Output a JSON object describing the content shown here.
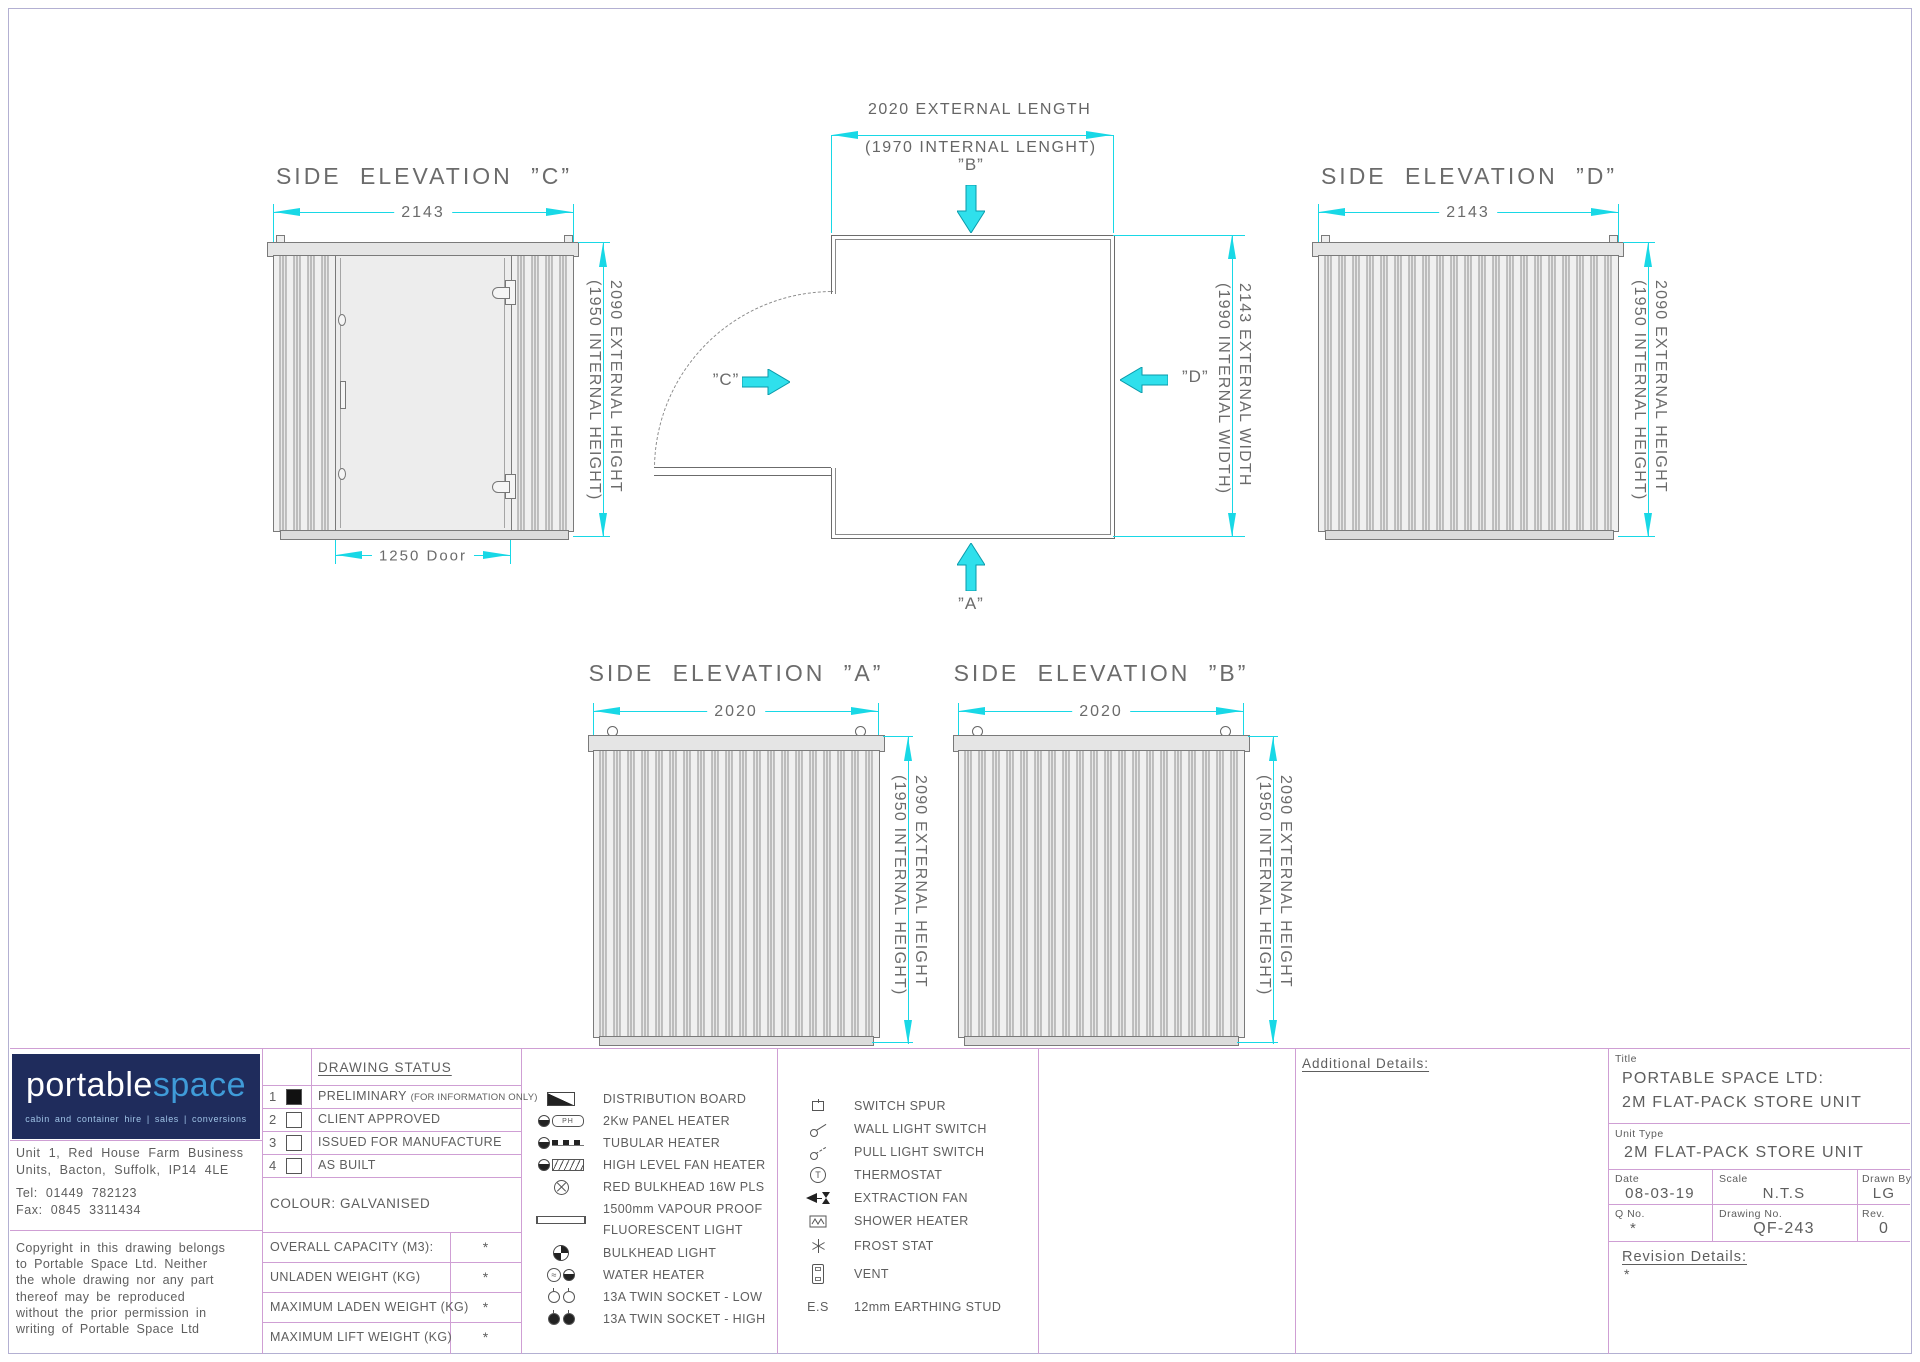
{
  "drawing": {
    "elev_c": {
      "title": "SIDE ELEVATION ”C”",
      "width_dim": "2143",
      "door_dim": "1250 Door"
    },
    "elev_d": {
      "title": "SIDE ELEVATION ”D”",
      "width_dim": "2143"
    },
    "elev_a": {
      "title": "SIDE ELEVATION ”A”",
      "width_dim": "2020"
    },
    "elev_b": {
      "title": "SIDE ELEVATION ”B”",
      "width_dim": "2020"
    },
    "height_dim": {
      "line1": "2090 EXTERNAL HEIGHT",
      "line2": "(1950 INTERNAL HEIGHT)"
    },
    "plan": {
      "length_dim_line1": "2020 EXTERNAL LENGTH",
      "length_dim_line2": "(1970 INTERNAL LENGHT)",
      "width_dim_line1": "2143 EXTERNAL WIDTH",
      "width_dim_line2": "(1990 INTERNAL WIDTH)",
      "label_a": "”A”",
      "label_b": "”B”",
      "label_c": "”C”",
      "label_d": "”D”"
    }
  },
  "title_block": {
    "logo": {
      "brand1": "portable",
      "brand2": "space",
      "tagline": "cabin and container hire   |   sales   |   conversions"
    },
    "address": {
      "line1": "Unit 1, Red House Farm Business",
      "line2": "Units, Bacton, Suffolk, IP14 4LE",
      "tel": "Tel:  01449 782123",
      "fax": "Fax:  0845 3311434"
    },
    "copyright": "Copyright in this drawing belongs\nto Portable Space Ltd. Neither\nthe whole drawing nor any part\nthereof may be reproduced\nwithout the prior permission in\nwriting of Portable Space Ltd",
    "status": {
      "header": "DRAWING STATUS",
      "rows": [
        {
          "num": "1",
          "label": "PRELIMINARY",
          "note": "(FOR INFORMATION ONLY)"
        },
        {
          "num": "2",
          "label": "CLIENT APPROVED",
          "note": ""
        },
        {
          "num": "3",
          "label": "ISSUED FOR MANUFACTURE",
          "note": ""
        },
        {
          "num": "4",
          "label": "AS BUILT",
          "note": ""
        }
      ]
    },
    "colour": "COLOUR: GALVANISED",
    "weights": [
      {
        "label": "OVERALL CAPACITY (M3):",
        "value": "*"
      },
      {
        "label": "UNLADEN WEIGHT (KG)",
        "value": "*"
      },
      {
        "label": "MAXIMUM LADEN WEIGHT (KG)",
        "value": "*"
      },
      {
        "label": "MAXIMUM LIFT WEIGHT (KG)",
        "value": "*"
      }
    ],
    "legend_col1": [
      {
        "label": "DISTRIBUTION BOARD"
      },
      {
        "label": "2Kw PANEL HEATER",
        "badge": "PH"
      },
      {
        "label": "TUBULAR HEATER"
      },
      {
        "label": "HIGH LEVEL FAN HEATER"
      },
      {
        "label": "RED BULKHEAD 16W PLS"
      },
      {
        "label": "1500mm VAPOUR PROOF",
        "label2": "FLUORESCENT LIGHT"
      },
      {
        "label": "BULKHEAD LIGHT"
      },
      {
        "label": "WATER HEATER"
      },
      {
        "label": "13A TWIN SOCKET - LOW"
      },
      {
        "label": "13A TWIN SOCKET - HIGH"
      }
    ],
    "legend_col2": [
      {
        "label": "SWITCH SPUR"
      },
      {
        "label": "WALL LIGHT SWITCH"
      },
      {
        "label": "PULL LIGHT SWITCH"
      },
      {
        "label": "THERMOSTAT",
        "letter": "T"
      },
      {
        "label": "EXTRACTION FAN"
      },
      {
        "label": "SHOWER HEATER"
      },
      {
        "label": "FROST STAT"
      },
      {
        "label": "VENT"
      },
      {
        "label": "12mm EARTHING STUD",
        "prefix": "E.S"
      }
    ],
    "additional_details_label": "Additional Details:",
    "fields": {
      "title_label": "Title",
      "title_line1": "PORTABLE SPACE LTD:",
      "title_line2": "2M FLAT-PACK STORE UNIT",
      "unit_type_label": "Unit Type",
      "unit_type": "2M FLAT-PACK STORE UNIT",
      "date_label": "Date",
      "date": "08-03-19",
      "scale_label": "Scale",
      "scale": "N.T.S",
      "drawn_by_label": "Drawn By",
      "drawn_by": "LG",
      "q_no_label": "Q No.",
      "q_no": "*",
      "drawing_no_label": "Drawing No.",
      "drawing_no": "QF-243",
      "rev_label": "Rev.",
      "rev": "0",
      "revision_details_label": "Revision Details:",
      "revision_details": "*"
    }
  },
  "colors": {
    "dimension": "#18d8e6",
    "grid": "#cf9fd4",
    "logo_bg": "#1f2c5c",
    "logo_accent": "#3f9bd8"
  }
}
